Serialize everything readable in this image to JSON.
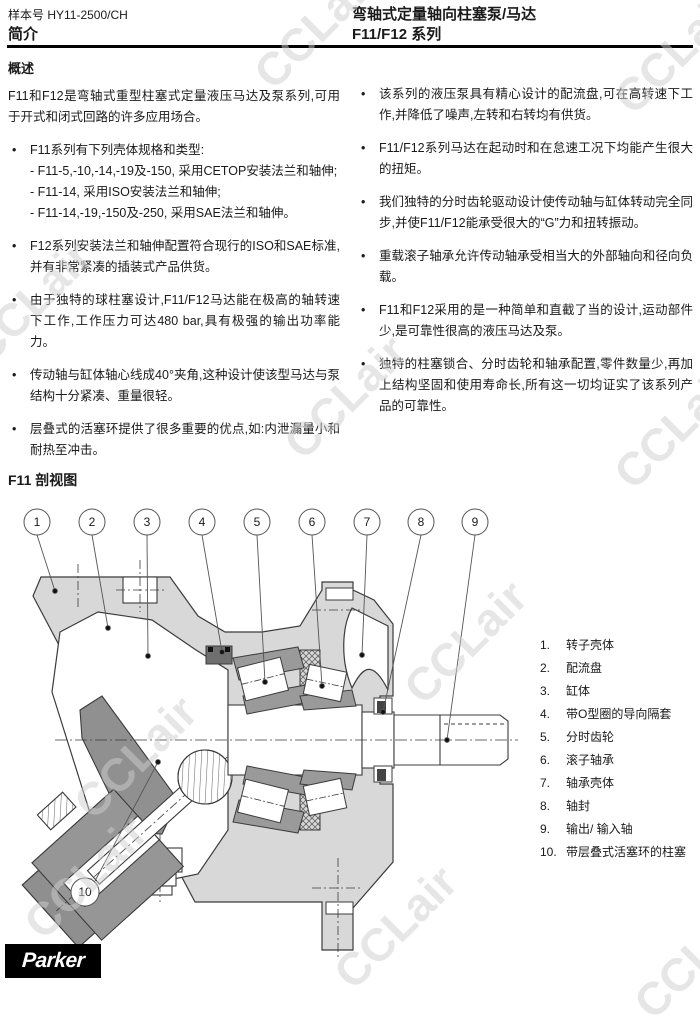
{
  "header": {
    "catalog_no": "样本号 HY11-2500/CH",
    "section_label": "简介",
    "title_line1": "弯轴式定量轴向柱塞泵/马达",
    "title_line2": "F11/F12 系列"
  },
  "overview": {
    "heading": "概述",
    "intro": "F11和F12是弯轴式重型柱塞式定量液压马达及泵系列,可用于开式和闭式回路的许多应用场合。"
  },
  "bullet_marker": "•",
  "left_bullets": [
    {
      "text": "F11系列有下列壳体规格和类型:",
      "subitems": [
        "- F11-5,-10,-14,-19及-150, 采用CETOP安装法兰和轴伸;",
        "- F11-14, 采用ISO安装法兰和轴伸;",
        "- F11-14,-19,-150及-250, 采用SAE法兰和轴伸。"
      ]
    },
    {
      "text": "F12系列安装法兰和轴伸配置符合现行的ISO和SAE标准,并有非常紧凑的插装式产品供货。"
    },
    {
      "text": "由于独特的球柱塞设计,F11/F12马达能在极高的轴转速下工作,工作压力可达480 bar,具有极强的输出功率能力。"
    },
    {
      "text": "传动轴与缸体轴心线成40°夹角,这种设计使该型马达与泵结构十分紧凑、重量很轻。"
    },
    {
      "text": "层叠式的活塞环提供了很多重要的优点,如:内泄漏量小和耐热至冲击。"
    }
  ],
  "right_bullets": [
    "该系列的液压泵具有精心设计的配流盘,可在高转速下工作,并降低了噪声,左转和右转均有供货。",
    "F11/F12系列马达在起动时和在怠速工况下均能产生很大的扭矩。",
    "我们独特的分时齿轮驱动设计使传动轴与缸体转动完全同步,并使F11/F12能承受很大的“G”力和扭转振动。",
    "重载滚子轴承允许传动轴承受相当大的外部轴向和径向负载。",
    "F11和F12采用的是一种简单和直截了当的设计,运动部件少,是可靠性很高的液压马达及泵。",
    "独特的柱塞锁合、分时齿轮和轴承配置,零件数量少,再加上结构坚固和使用寿命长,所有这一切均证实了该系列产品的可靠性。"
  ],
  "section": {
    "heading": "F11 剖视图"
  },
  "legend": {
    "items": [
      {
        "num": "1.",
        "label": "转子壳体"
      },
      {
        "num": "2.",
        "label": "配流盘"
      },
      {
        "num": "3.",
        "label": "缸体"
      },
      {
        "num": "4.",
        "label": "带O型圈的导向隔套"
      },
      {
        "num": "5.",
        "label": "分时齿轮"
      },
      {
        "num": "6.",
        "label": "滚子轴承"
      },
      {
        "num": "7.",
        "label": "轴承壳体"
      },
      {
        "num": "8.",
        "label": "轴封"
      },
      {
        "num": "9.",
        "label": "输出/ 输入轴"
      },
      {
        "num": "10.",
        "label": "带层叠式活塞环的柱塞"
      }
    ]
  },
  "callouts": [
    "1",
    "2",
    "3",
    "4",
    "5",
    "6",
    "7",
    "8",
    "9",
    "10"
  ],
  "logo": {
    "text": "Parker"
  },
  "watermark": {
    "text": "CCLair"
  },
  "colors": {
    "housing_gray": "#d8d8d8",
    "part_gray": "#969696",
    "line": "#3b3b3b",
    "text": "#1a1a1a",
    "watermark": "#e2e2e2"
  }
}
